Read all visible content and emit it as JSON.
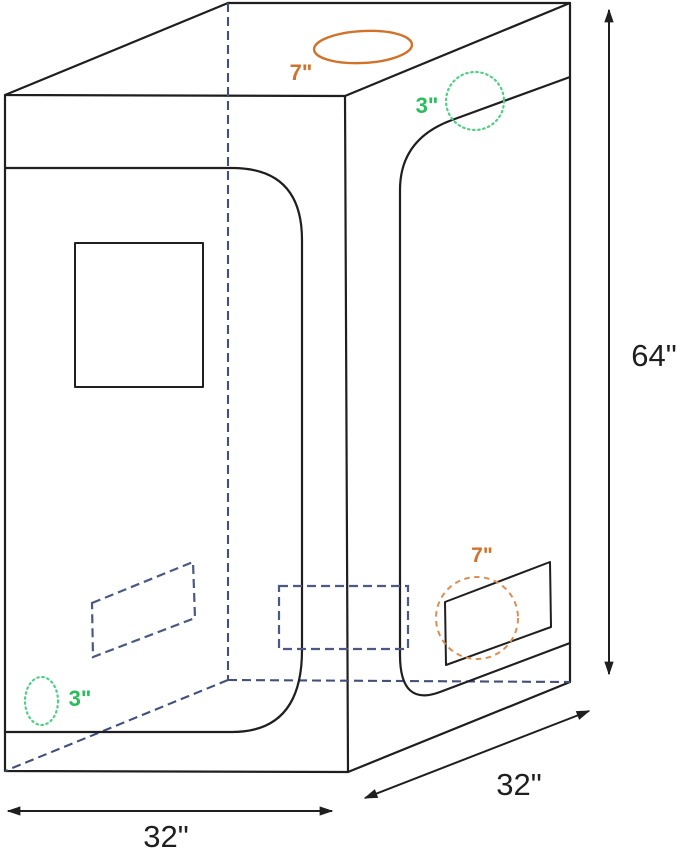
{
  "diagram": {
    "type": "grow-tent-dimension-diagram",
    "labels": {
      "top_duct_port": "7\"",
      "top_vent_port": "3\"",
      "side_duct_port": "7\"",
      "bottom_vent_port": "3\"",
      "height": "64\"",
      "base_width": "32\"",
      "base_depth": "32\""
    },
    "colors": {
      "outline_black": "#1f1f1f",
      "hidden_edge_blue": "#42507a",
      "vent_dashed_blue": "#4a5a82",
      "vent_green": "#4fd084",
      "vent_green_text": "#2abd5c",
      "duct_orange": "#d2722a",
      "duct_orange_dashed": "#d98f55"
    }
  }
}
